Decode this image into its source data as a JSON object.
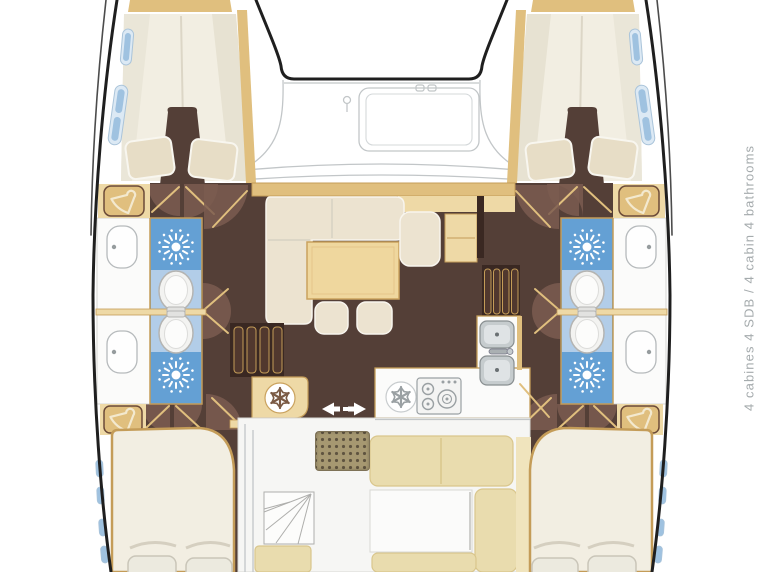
{
  "side_label": {
    "text": "4 cabines 4 SDB / 4 cabin 4 bathrooms",
    "text_fr": "4 cabines 4 SDB",
    "text_en": "4 cabin 4 bathrooms",
    "cabins": 4,
    "bathrooms": 4
  },
  "icons": {
    "shower": "sunburst-shower-icon",
    "wardrobe": "clothes-hanger-icon",
    "fridge": "snowflake-icon",
    "sliding_door": "left-right-arrows-icon",
    "toilet": "toilet-icon",
    "sink": "sink-basin-icon",
    "stove": "stove-burners-icon"
  },
  "colors": {
    "hull_outline": "#1f1f1f",
    "deck_line": "#c2c6c8",
    "wood_light": "#eed9a6",
    "wood_mid": "#e0bf7e",
    "wood_dark": "#c49c58",
    "floor_dark": "#543f37",
    "floor_darker": "#3a2822",
    "door_arc": "#7b5c50",
    "cushion": "#ece3d0",
    "bed": "#f2eee2",
    "pillow": "#e7ddc6",
    "bath_blue": "#64a0d4",
    "bath_blue_light": "#b2cde8",
    "counter_white": "#fbfbfa",
    "sink_gray": "#c6ccce",
    "steel_gray": "#9aa0a3",
    "bench": "#e9dcae",
    "bench_light": "#f0e4bd",
    "grate": "#a69871",
    "grate_dot": "#5f5440",
    "window_blue": "#9fc2e0",
    "window_frame": "#dce9f4",
    "text_gray": "#a5abad"
  }
}
